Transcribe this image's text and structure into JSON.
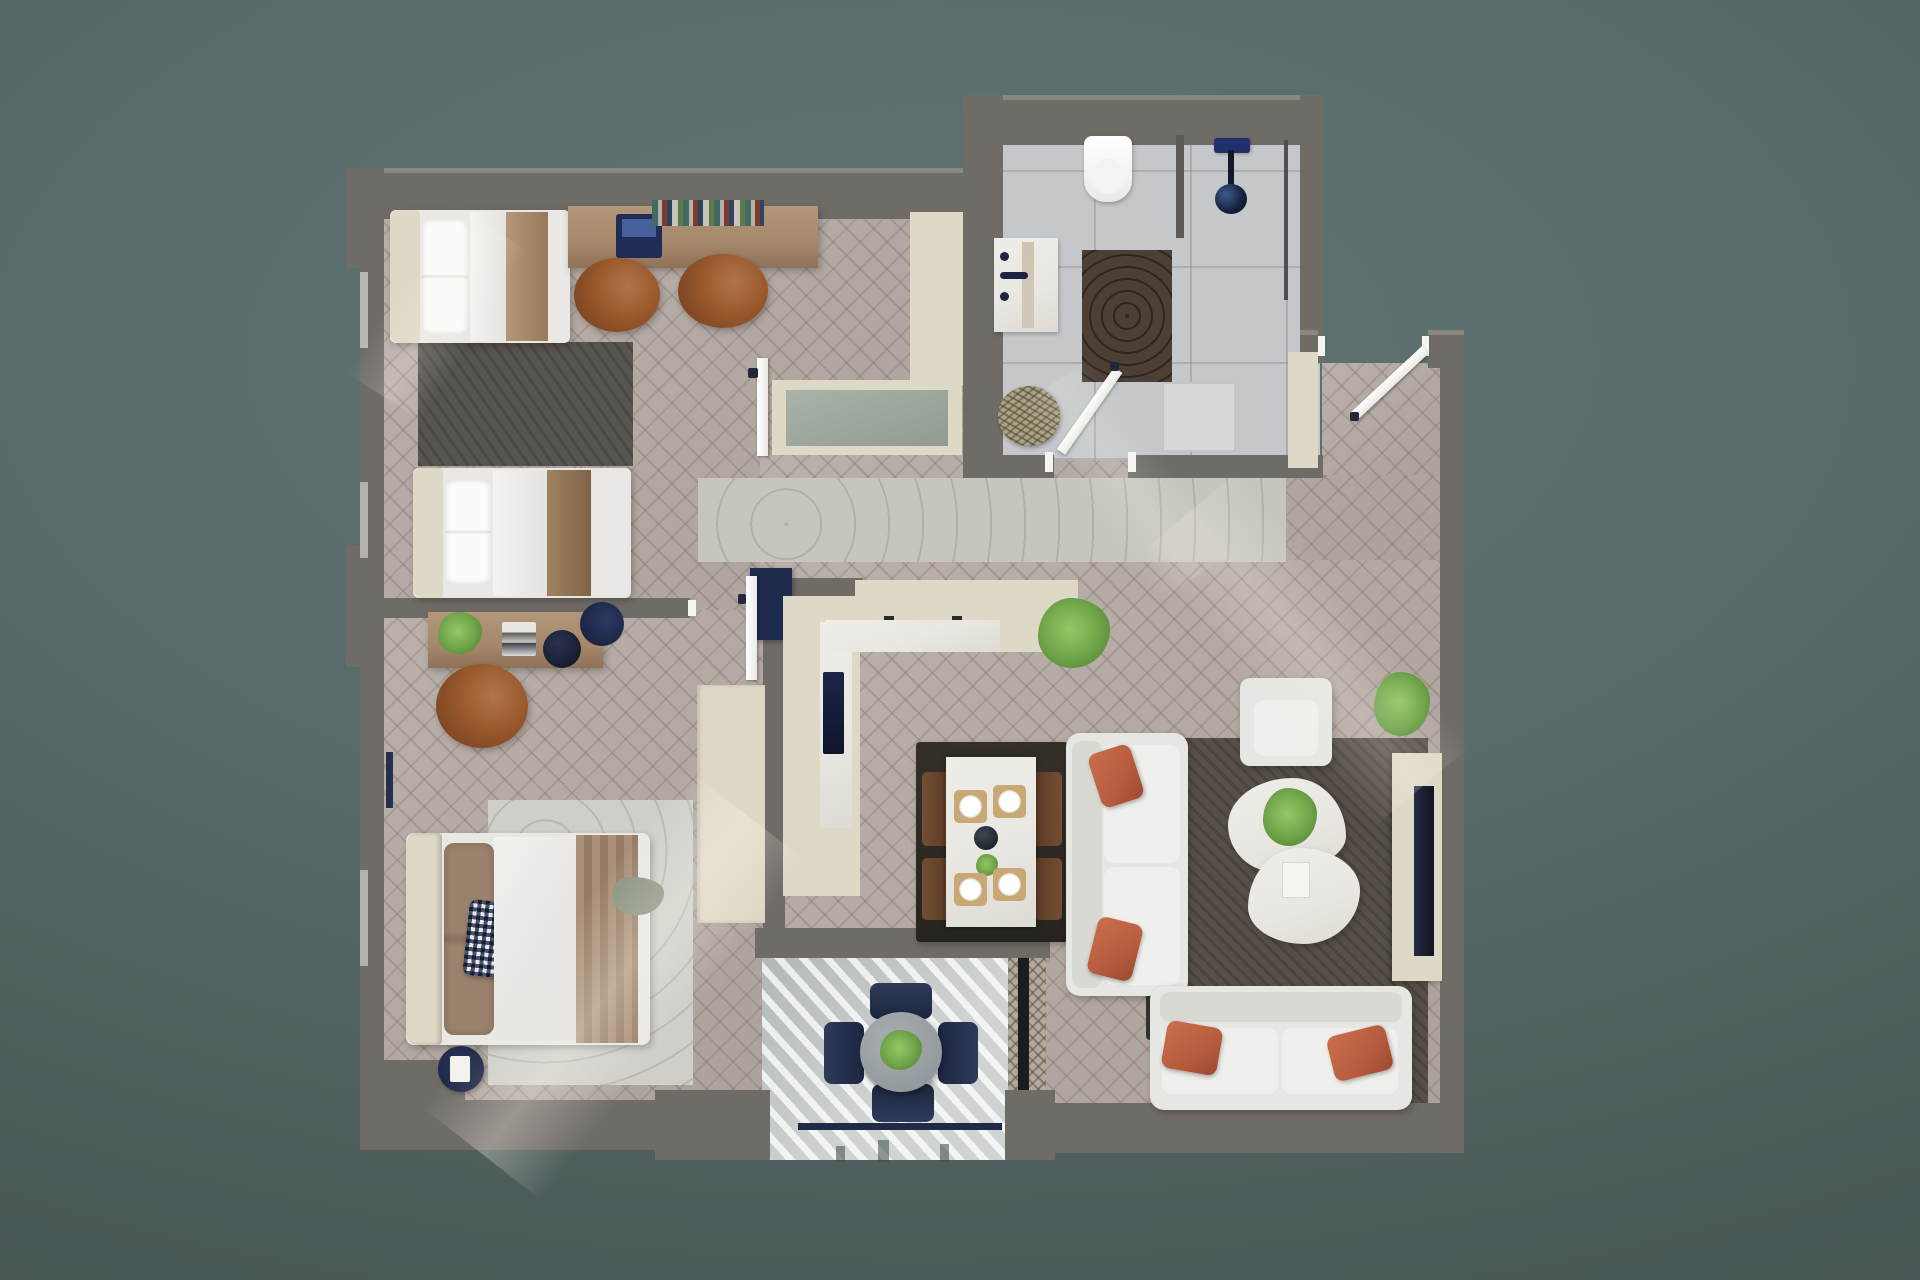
{
  "scene": {
    "type": "apartment-floor-plan-3d-render",
    "view": "top-down",
    "style": "photoreal dollhouse render on teal-gray backdrop"
  },
  "palette": {
    "background_center": "#5f7473",
    "background_edge": "#435251",
    "wall": "#6f6b67",
    "wall_top": "#8a8680",
    "floor_herringbone": "#b5aaa4",
    "bath_tile": "#c4c8ca",
    "balcony_floor": "#cfd4d3",
    "runner_wood": "#c8c5bf",
    "rug_master": "#cfcec9",
    "rug_twin": "#585450",
    "rug_living": "#57504a",
    "rug_bath": "#4c4036",
    "cream": "#ded8c6",
    "marble": "#e9e7e2",
    "sofa": "#e6e6e2",
    "terracotta": "#b75c3e",
    "leather": "#99582c",
    "navy": "#1f2b4d",
    "wood_desk": "#a5886a",
    "plant": "#6da348"
  },
  "rooms": [
    {
      "name": "twin-bedroom",
      "contents": [
        "single bed x2",
        "dark gray rug",
        "wood desk with laptop and books",
        "two leather desk chairs"
      ]
    },
    {
      "name": "bathroom",
      "contents": [
        "wall-hung toilet",
        "vanity with dark faucet",
        "navy shower set",
        "brown cobble rug",
        "shower tray",
        "woven basket"
      ]
    },
    {
      "name": "entry-hall",
      "contents": [
        "entrance door",
        "built-in cream cabinet",
        "herringbone floor"
      ]
    },
    {
      "name": "hallway",
      "contents": [
        "light wood runner rug",
        "cream bench-tub niche"
      ]
    },
    {
      "name": "kitchen-dining",
      "contents": [
        "L-shaped cream counter",
        "navy sink",
        "tall dark cabinet",
        "counter plant",
        "marble dining table",
        "four dark chairs",
        "place settings x4"
      ]
    },
    {
      "name": "living-room",
      "contents": [
        "three-seat sofa",
        "two-seat sofa",
        "armchair",
        "organic marble coffee table",
        "dark gray rug",
        "TV console with TV",
        "floor plant",
        "terracotta pillows x4"
      ]
    },
    {
      "name": "master-bedroom",
      "contents": [
        "double bed",
        "checkered pillow",
        "wavy light rug",
        "wood sideboard with plant, magazines and lamp",
        "leather armchair",
        "navy pouf with book",
        "cream wardrobe"
      ]
    },
    {
      "name": "balcony",
      "contents": [
        "round table with plant",
        "four navy chairs",
        "navy railing",
        "striped sunlit floor",
        "cane screen"
      ]
    }
  ]
}
